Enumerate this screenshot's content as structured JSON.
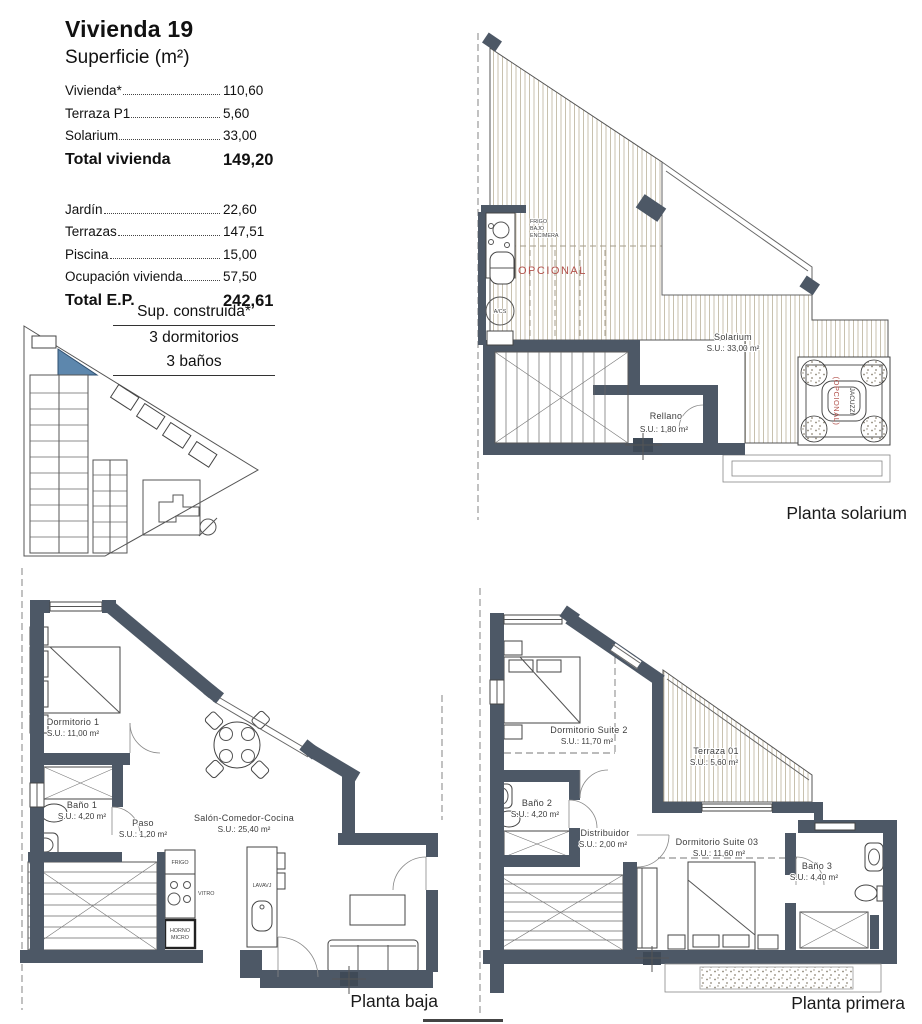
{
  "info_panel": {
    "title": "Vivienda 19",
    "subtitle": "Superficie (m²)",
    "surface_rows": [
      {
        "label": "Vivienda*",
        "value": "110,60"
      },
      {
        "label": "Terraza P1",
        "value": "5,60"
      },
      {
        "label": "Solarium",
        "value": "33,00"
      }
    ],
    "total_vivienda": {
      "label": "Total vivienda",
      "value": "149,20"
    },
    "exterior_rows": [
      {
        "label": "Jardín",
        "value": "22,60"
      },
      {
        "label": "Terrazas",
        "value": "147,51"
      },
      {
        "label": "Piscina",
        "value": "15,00"
      },
      {
        "label": "Ocupación vivienda",
        "value": "57,50"
      }
    ],
    "total_ep": {
      "label": "Total E.P.",
      "value": "242,61"
    },
    "construida": {
      "line1": "Sup. construida*",
      "line2": "3 dormitorios",
      "line3": "3 baños"
    }
  },
  "plans": {
    "solarium": {
      "caption": "Planta solarium",
      "rooms": {
        "solarium": {
          "name": "Solarium",
          "area": "S.U.: 33,00 m²"
        },
        "rellano": {
          "name": "Rellano",
          "area": "S.U.: 1,80 m²"
        }
      },
      "labels": {
        "frigo_l1": "FRIGO",
        "frigo_l2": "BAJO",
        "frigo_l3": "ENCIMERA",
        "opcional": "OPCIONAL",
        "acs": "A/CS",
        "jacuzzi": "JACUZZI",
        "jacuzzi_opcional": "(OPCIONAL)"
      }
    },
    "baja": {
      "caption": "Planta baja",
      "rooms": {
        "dormitorio1": {
          "name": "Dormitorio 1",
          "area": "S.U.: 11,00 m²"
        },
        "bano1": {
          "name": "Baño 1",
          "area": "S.U.: 4,20 m²"
        },
        "paso": {
          "name": "Paso",
          "area": "S.U.: 1,20 m²"
        },
        "salon": {
          "name": "Salón-Comedor-Cocina",
          "area": "S.U.: 25,40 m²"
        }
      },
      "labels": {
        "frigo": "FRIGO",
        "vitro": "VITRO",
        "horno_l1": "HORNO",
        "horno_l2": "MICRO",
        "lavavajillas": "LAVAVJ"
      }
    },
    "primera": {
      "caption": "Planta primera",
      "rooms": {
        "suite2": {
          "name": "Dormitorio Suite 2",
          "area": "S.U.: 11,70 m²"
        },
        "terraza": {
          "name": "Terraza 01",
          "area": "S.U.: 5,60 m²"
        },
        "bano2": {
          "name": "Baño 2",
          "area": "S.U.: 4,20 m²"
        },
        "distribuidor": {
          "name": "Distribuidor",
          "area": "S.U.: 2,00 m²"
        },
        "suite03": {
          "name": "Dormitorio Suite 03",
          "area": "S.U.: 11,60 m²"
        },
        "bano3": {
          "name": "Baño 3",
          "area": "S.U.: 4,40 m²"
        }
      }
    }
  },
  "colors": {
    "wall": "#4d5866",
    "highlighted_unit": "#5d87ad",
    "optional_red": "#b2514b",
    "deck_hatch": "#c8c1af"
  }
}
